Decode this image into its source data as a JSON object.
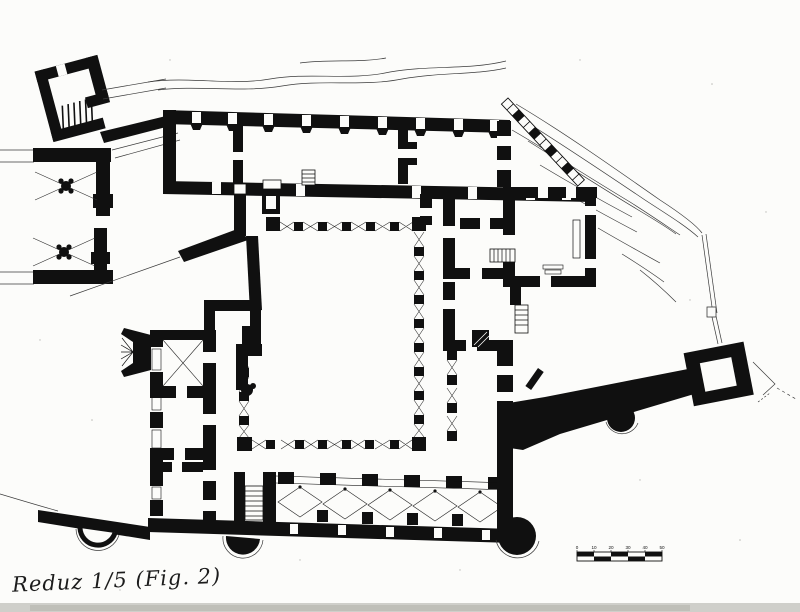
{
  "drawing": {
    "caption": "Reduz 1/5 (Fig. 2)"
  },
  "scale_bar": {
    "labels": [
      "0",
      "10",
      "20",
      "30",
      "40",
      "50"
    ]
  },
  "colors": {
    "ink": "#101010",
    "paper": "#fcfcfa",
    "thin_line": "#3a3a3a"
  }
}
